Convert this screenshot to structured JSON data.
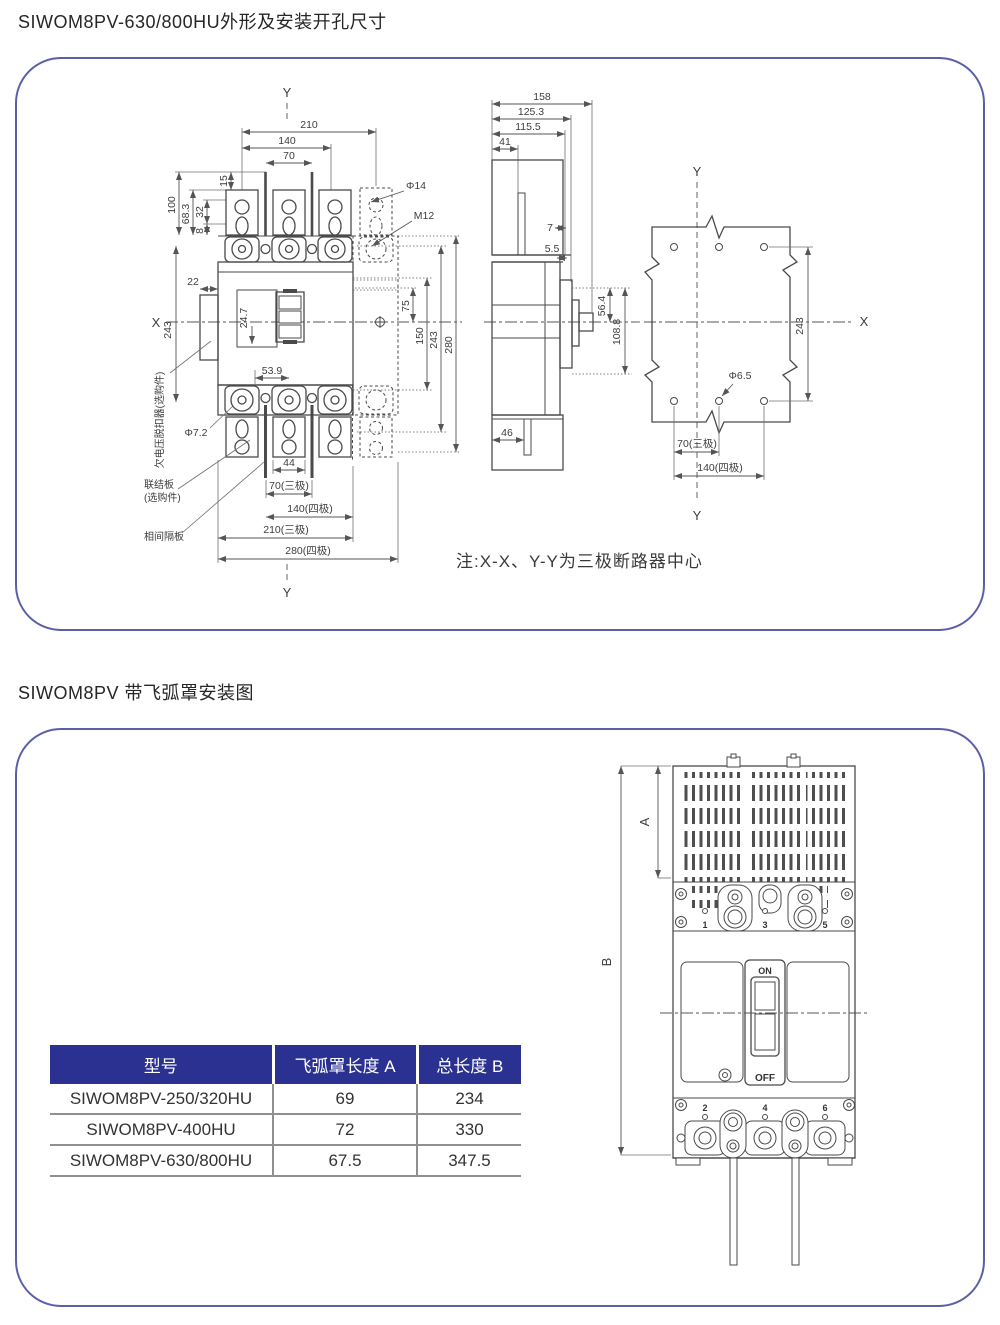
{
  "titles": {
    "section1": "SIWOM8PV-630/800HU外形及安装开孔尺寸",
    "section2": "SIWOM8PV 带飞弧罩安装图"
  },
  "note": "注:X-X、Y-Y为三极断路器中心",
  "colors": {
    "panel_border": "#5b5fa8",
    "table_header_bg": "#2b3190",
    "table_header_text": "#ffffff",
    "drawing_line": "#4a4a4a"
  },
  "front_view": {
    "axis": {
      "x": "X",
      "y_top": "Y",
      "y_bottom": "Y"
    },
    "dims": {
      "w210": "210",
      "w140": "140",
      "w70": "70",
      "h100": "100",
      "h68_3": "68.3",
      "h32": "32",
      "h8": "8",
      "h15": "15",
      "phi14": "Φ14",
      "m12": "M12",
      "w22": "22",
      "h243_left": "243",
      "d24_7": "24.7",
      "d53_9": "53.9",
      "h75": "75",
      "h150": "150",
      "h243_right": "243",
      "h280": "280",
      "phi7_2": "Φ7.2",
      "w44": "44",
      "w70_3p": "70(三极)",
      "w140_4p": "140(四极)",
      "w210_3p": "210(三极)",
      "w280_4p": "280(四极)"
    },
    "labels": {
      "undervoltage_release": "欠电压脱扣器(选购件)",
      "connection_plate_line1": "联结板",
      "connection_plate_line2": "(选购件)",
      "phase_barrier": "相间隔板"
    }
  },
  "side_view": {
    "dims": {
      "w158": "158",
      "w125_3": "125.3",
      "w115_5": "115.5",
      "w41": "41",
      "d7": "7",
      "d5_5": "5.5",
      "h56_4": "56.4",
      "h108_8": "108.8",
      "w46": "46"
    }
  },
  "drill_plan": {
    "axis": {
      "x": "X",
      "y_top": "Y",
      "y_bottom": "Y"
    },
    "dims": {
      "h243": "243",
      "phi6_5": "Φ6.5",
      "w70_3p": "70(三极)",
      "w140_4p": "140(四极)"
    }
  },
  "arc_view": {
    "dim_a": "A",
    "dim_b": "B",
    "handle_on": "ON",
    "handle_off": "OFF",
    "terminals_top": {
      "t1": "1",
      "t3": "3",
      "t5": "5"
    },
    "terminals_bottom": {
      "t2": "2",
      "t4": "4",
      "t6": "6"
    }
  },
  "table": {
    "headers": [
      "型号",
      "飞弧罩长度 A",
      "总长度 B"
    ],
    "rows": [
      [
        "SIWOM8PV-250/320HU",
        "69",
        "234"
      ],
      [
        "SIWOM8PV-400HU",
        "72",
        "330"
      ],
      [
        "SIWOM8PV-630/800HU",
        "67.5",
        "347.5"
      ]
    ]
  }
}
